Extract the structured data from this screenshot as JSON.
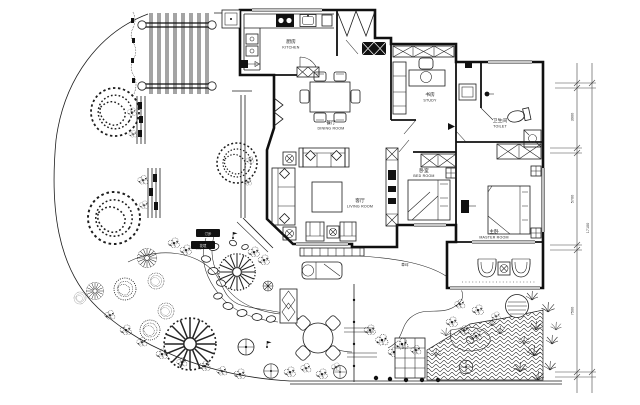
{
  "plan": {
    "rooms": {
      "kitchen": {
        "zh": "厨房",
        "en": "KITCHEN"
      },
      "dining": {
        "zh": "餐厅",
        "en": "DINING ROOM"
      },
      "study": {
        "zh": "书房",
        "en": "STUDY"
      },
      "toilet": {
        "zh": "卫生间",
        "en": "TOILET"
      },
      "living": {
        "zh": "客厅",
        "en": "LIVING ROOM"
      },
      "bedroom": {
        "zh": "卧室",
        "en": "BED ROOM"
      },
      "master": {
        "zh": "主卧",
        "en": "MASTER ROOM"
      }
    },
    "garden": {
      "lawn_label": "草坪",
      "tag_stepping": "汀步",
      "tag_flowerbed": "花境"
    },
    "dimensions": {
      "seg1": "3900",
      "seg2": "5700",
      "seg3": "7500",
      "total": "17100"
    },
    "colors": {
      "ink": "#1a1a1a",
      "paper": "#ffffff"
    }
  }
}
